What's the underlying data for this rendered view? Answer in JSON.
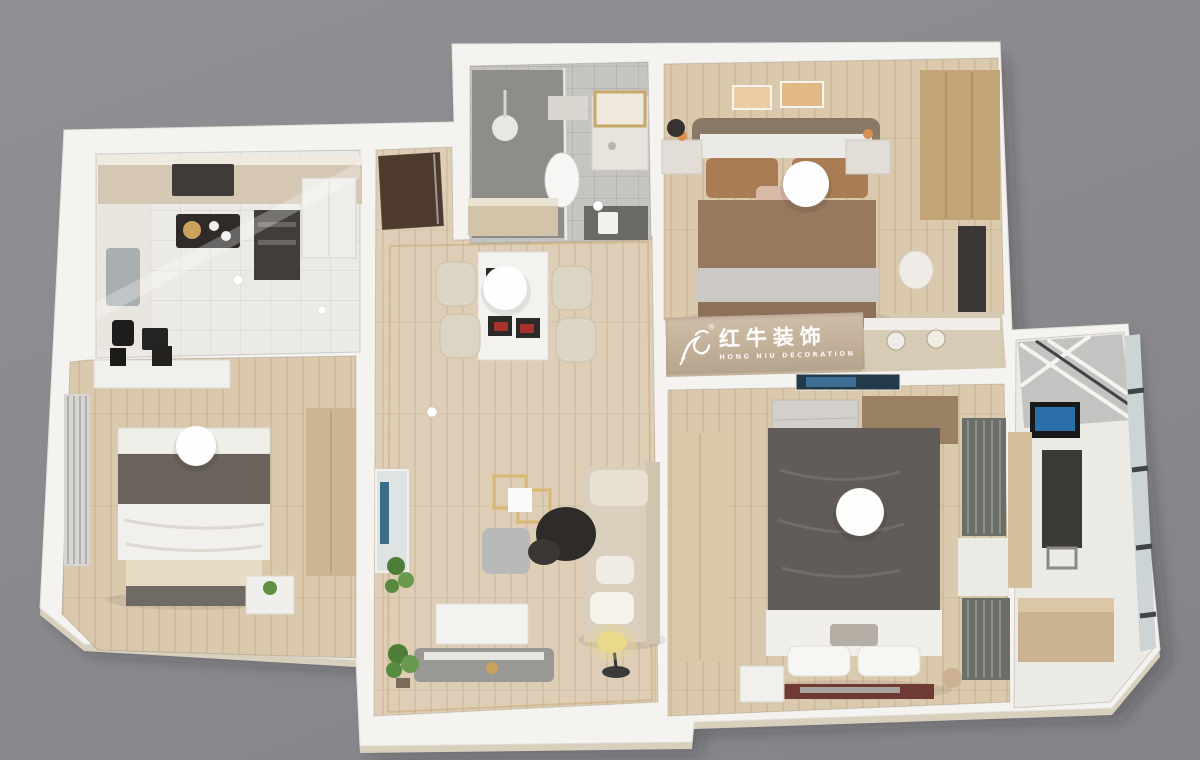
{
  "meta": {
    "description": "Photorealistic 3D isometric (bird's-eye) rendering of a three-bedroom apartment floor plan on a plain gray backdrop",
    "background_color": "#8a8a8f"
  },
  "watermark": {
    "brand_cn": "红牛装饰",
    "brand_en": "HONG NIU DECORATION",
    "registered_mark": "®",
    "logo": "bull-swoosh-icon",
    "band_color": "#c2b098",
    "text_color": "#ffffff"
  },
  "palette": {
    "outer_wall": "#f4f3f0",
    "wall_underside": "#d9cfbd",
    "wood_floor": "#dbc9ad",
    "kitchen_tile": "#ebeae7",
    "bathroom_tile": "#c6c4c1",
    "counter_tan": "#d6c7b2",
    "wardrobe_tan": "#c3a477",
    "bed_brown": "#97795f",
    "duvet_dark_gray": "#615c58",
    "sofa_beige": "#d9cfbc",
    "accent_gold": "#c9a96a",
    "balcony_glass": "#cdd4d6"
  },
  "scene": {
    "type": "3d-floor-plan-render",
    "rooms": [
      {
        "name": "kitchen",
        "items": [
          "l-shaped-counter",
          "cooktop",
          "coffee-station",
          "fridge",
          "oven-stack",
          "sink"
        ]
      },
      {
        "name": "bathroom",
        "items": [
          "shower-area",
          "toilet",
          "vanity-with-gold-mirror",
          "washer-nook"
        ]
      },
      {
        "name": "master-bedroom",
        "items": [
          "double-bed",
          "nightstands",
          "wall-frames",
          "wardrobe",
          "tv-panel",
          "ceiling-lamp"
        ]
      },
      {
        "name": "entry-hall",
        "items": [
          "entry-door-mat",
          "shoe-cabinet"
        ]
      },
      {
        "name": "living-dining-room",
        "items": [
          "dining-table",
          "four-chairs",
          "pendant-lamp",
          "square-gold-chandelier",
          "ottoman",
          "l-sofa",
          "tv-bench",
          "floor-lamp",
          "plants",
          "leaning-art"
        ]
      },
      {
        "name": "second-bedroom",
        "items": [
          "double-bed",
          "curtained-window",
          "wardrobe",
          "nightstand-with-plant",
          "ceiling-lamp"
        ]
      },
      {
        "name": "third-bedroom",
        "items": [
          "double-bed",
          "desk",
          "dresser",
          "stool",
          "wall-tv",
          "striped-wardrobes",
          "foot-tray",
          "ceiling-lamp"
        ]
      },
      {
        "name": "balcony-sunroom",
        "items": [
          "glazed-roof",
          "glass-wall",
          "monitor",
          "dark-work-table",
          "tan-cabinet"
        ]
      },
      {
        "name": "hall-vanity",
        "items": [
          "basin-counter",
          "two-bowls"
        ]
      }
    ]
  }
}
